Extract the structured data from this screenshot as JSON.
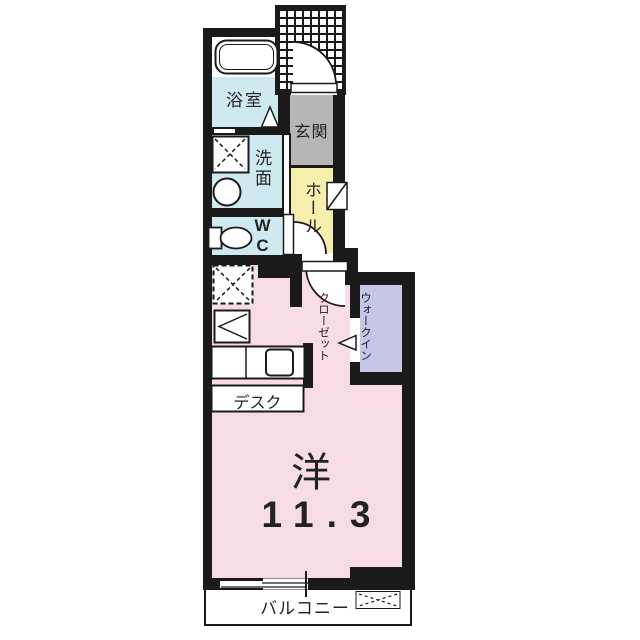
{
  "floorplan": {
    "rooms": {
      "bathroom": {
        "label": "浴室"
      },
      "entrance": {
        "label": "玄関"
      },
      "washroom": {
        "label": "洗面"
      },
      "toilet": {
        "label": "WC"
      },
      "hall": {
        "label": "ホール"
      },
      "walk_in_closet": {
        "label_line1": "ウォークイン",
        "label_line2": "クローゼット",
        "full_label": "ウォークインクローゼット"
      },
      "main_room": {
        "label": "洋",
        "size_tatami": "11.3"
      },
      "desk": {
        "label": "デスク"
      },
      "balcony": {
        "label": "バルコニー"
      }
    },
    "fixtures": [
      "bathtub",
      "bathroom-door-triangle",
      "washing-machine-space",
      "washbasin",
      "toilet",
      "entrance-door-swing",
      "shoe-cabinet",
      "interior-door-swings",
      "refrigerator-space",
      "mini-kitchen-unit",
      "kitchen-counter",
      "walk-in-closet-entry-arrow",
      "balcony-window",
      "outdoor-unit-space",
      "porch-hatch"
    ],
    "colors": {
      "wet_area_blue": "#cfe9f1",
      "hall_yellow": "#f6efad",
      "entrance_gray": "#b6b6b6",
      "closet_lavender": "#c6c6e9",
      "room_pink": "#f8dce3",
      "wall_black": "#1a1a1a",
      "background": "#ffffff"
    }
  }
}
